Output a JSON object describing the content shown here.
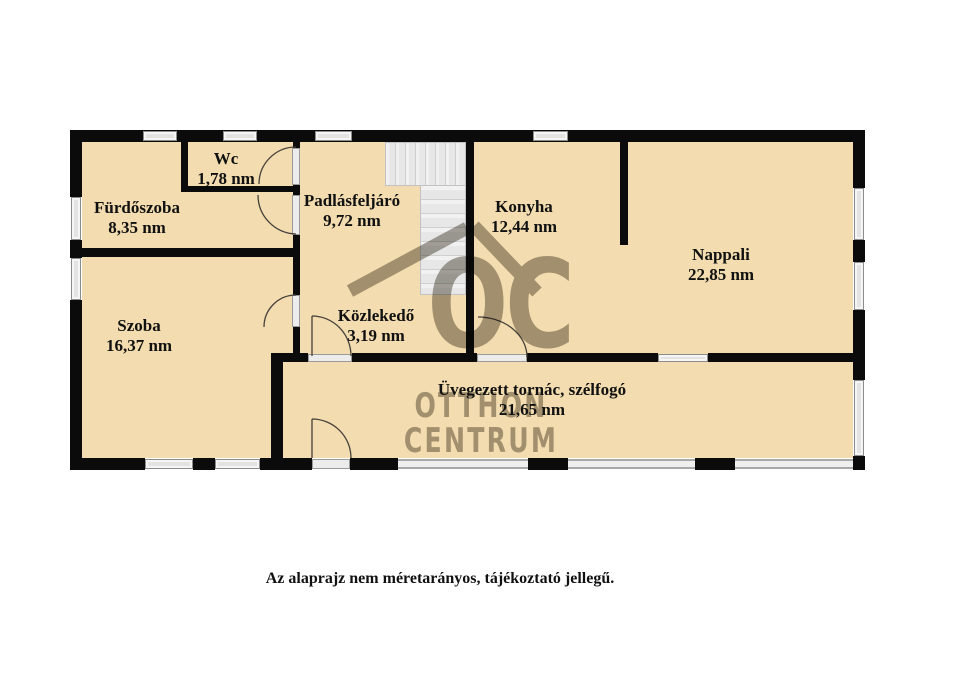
{
  "rooms": [
    {
      "id": "wc",
      "name": "Wc",
      "area": "1,78 nm"
    },
    {
      "id": "furdoszoba",
      "name": "Fürdőszoba",
      "area": "8,35 nm"
    },
    {
      "id": "padlasfeljaro",
      "name": "Padlásfeljáró",
      "area": "9,72 nm"
    },
    {
      "id": "konyha",
      "name": "Konyha",
      "area": "12,44 nm"
    },
    {
      "id": "nappali",
      "name": "Nappali",
      "area": "22,85 nm"
    },
    {
      "id": "szoba",
      "name": "Szoba",
      "area": "16,37 nm"
    },
    {
      "id": "kozlekedo",
      "name": "Közlekedő",
      "area": "3,19 nm"
    },
    {
      "id": "tornac",
      "name": "Üvegezett tornác, szélfogó",
      "area": "21,65 nm"
    }
  ],
  "watermark": {
    "logo_text": "OC",
    "line1": "OTTHON",
    "line2": "CENTRUM"
  },
  "footer_note": "Az alaprajz nem méretarányos, tájékoztató jellegű.",
  "colors": {
    "room_fill": "#f3ddb0",
    "wall": "#0b0b0b",
    "window_fill": "#f5f5f5",
    "stair_fill": "#ededed",
    "watermark_gray": "#a9a59e"
  }
}
